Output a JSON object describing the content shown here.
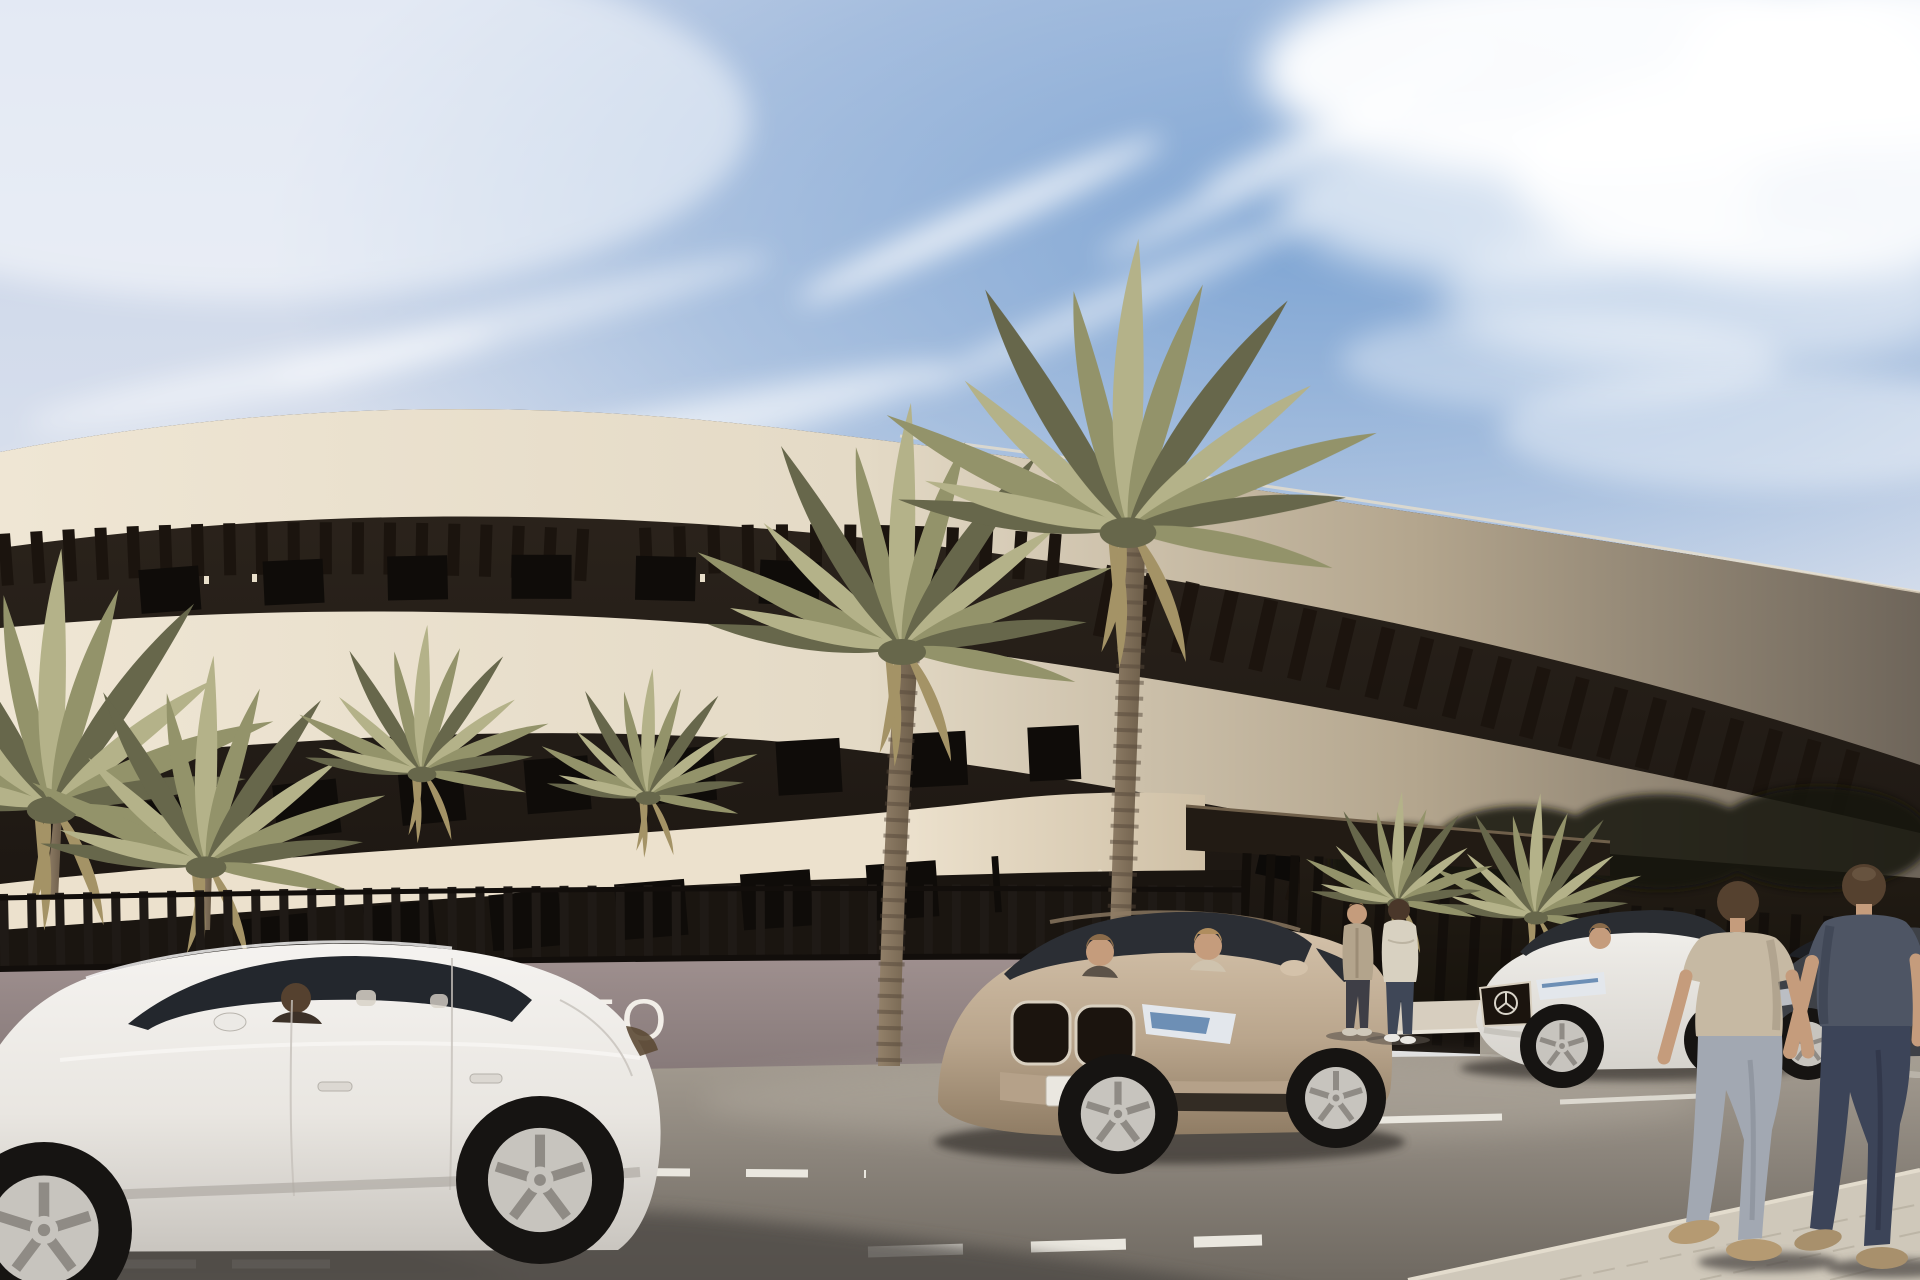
{
  "meta": {
    "scene_type": "architectural exterior rendering",
    "description": "Sunny street view of a curved modern cream apartment building with dark recessed floors, roof pergola louvers, slatted perimeter fence, entrance canopy, tall palm trees, parked cars and pedestrians"
  },
  "sign": {
    "visible_text": "TO"
  },
  "scene": {
    "building": {
      "label": "curved white apartment building",
      "floors_visible": 3,
      "features": [
        "roof pergola louvers",
        "recessed dark window bands",
        "entrance canopy",
        "slatted perimeter fence",
        "wall sign partially hidden by parked car"
      ]
    },
    "vehicles": [
      {
        "label": "white sedan parked foreground left",
        "occupants": 1
      },
      {
        "label": "champagne SUV parked center",
        "occupants": 2
      },
      {
        "label": "white mercedes sedan parked right",
        "occupants": 1
      },
      {
        "label": "dark sedan parked far right",
        "occupants": 0
      }
    ],
    "people": [
      {
        "label": "man walking away in tan t-shirt and light jeans"
      },
      {
        "label": "man walking away in dark slate t-shirt and dark jeans"
      },
      {
        "label": "person in beige cardigan talking at entrance"
      },
      {
        "label": "person in cream sweater talking at entrance"
      }
    ],
    "vegetation": [
      {
        "label": "two tall canary palms in front of facade"
      },
      {
        "label": "small palms behind fence left"
      },
      {
        "label": "yucca plant at entrance"
      },
      {
        "label": "dark trees behind right fence"
      }
    ],
    "road": {
      "surface": "asphalt",
      "markings": [
        "white parking bay lines",
        "short dashed bay dividers",
        "dashed lane line bottom center",
        "white line bottom left"
      ],
      "sidewalk": "light pavers bottom right and entrance walkway"
    },
    "sky": {
      "condition": "blue sky with diagonal wispy clouds, bright cloud mass top right"
    }
  },
  "colors": {
    "sky_top": "#c7d3e8",
    "sky_mid": "#dde3ee",
    "sky_low": "#eceae6",
    "sky_blue": "#7aa2d2",
    "cloud": "#ffffff",
    "band_lit": "#efe6d4",
    "band_lit2": "#e4dac6",
    "band_shade_mid": "#b3a58d",
    "band_shade": "#6e655a",
    "band3_lit": "#ece1cd",
    "band3_end": "#cfc0a6",
    "mass_top": "#2e261e",
    "mass_bot": "#17120e",
    "louver": "#1b140e",
    "window": "#0f0c09",
    "window2": "#0c0a08",
    "soffit_light": "#e9dfca",
    "canopy": "#221b14",
    "canopy_edge": "#6f5f4a",
    "darkzone_top": "#241d16",
    "darkzone_bot": "#131009",
    "treeblob": "#181507",
    "slat": "#1f1a16",
    "rail": "#120e0b",
    "wall": "#9e8f8e",
    "wall_shade": "#857878",
    "sign_text": "#f2eee8",
    "walkway": "#d7cebf",
    "curb_light": "#e9e4da",
    "curb_shade": "#d0cabd",
    "rightcurb": "#b4ada1",
    "road_top": "#a39b90",
    "road_mid": "#8b847b",
    "road_bot": "#6f6961",
    "road_shadow": "#4f4b46",
    "marking": "#eae7df",
    "sidewalk": "#cfc8ba",
    "sidewalk_joint": "#b5ad9e",
    "sidewalk_edge": "#e3dccd",
    "palm_light": "#b4b289",
    "palm_mid": "#93936a",
    "palm_dark": "#67674b",
    "palm_dead": "#a49366",
    "trunk_light": "#93816a",
    "trunk_dark": "#6b5c48",
    "trunk_ring": "#55483a",
    "car_white_hi": "#f5f3f0",
    "car_white": "#e9e6e1",
    "car_white_lo": "#c9c5bf",
    "car_glass": "#23272d",
    "tire": "#161412",
    "rim": "#c7c4be",
    "rim_dark": "#8f8b85",
    "suv_hi": "#d4c2aa",
    "suv_mid": "#b9a58c",
    "suv_lo": "#8f7c64",
    "suv_glass": "#2b2e34",
    "chrome": "#d9d0c0",
    "headlight": "#e3e7ec",
    "headlight_blue": "#6d8fb5",
    "plate": "#eae7e0",
    "merc_hi": "#f0eeea",
    "merc_lo": "#d6d3cd",
    "merc_glass": "#2a2d32",
    "darkcar": "#3e4147",
    "darkcar_glass": "#1e2025",
    "skin": "#c59c7c",
    "hair_dark": "#4a372a",
    "hair_mid": "#55412f",
    "hair_light": "#8a6b4a",
    "hair_blond": "#b08d5e",
    "tee_tan": "#c6b9a3",
    "tee_tan_shade": "#a89b86",
    "jeans_light": "#a2a8b2",
    "jeans_light_shade": "#8a909a",
    "tee_slate": "#4e5564",
    "tee_slate_shade": "#3f4554",
    "jeans_dark": "#3c4458",
    "jeans_dark_shade": "#2f3648",
    "shoe_tan": "#b59a72",
    "shoe_tan2": "#a8906c",
    "cardigan": "#b3a48c",
    "pants_dark": "#3e3e46",
    "sweater": "#d8d1c1",
    "jeans_couple": "#3f4757",
    "shoe_white": "#e9e7e2",
    "shadow": "#474340"
  }
}
